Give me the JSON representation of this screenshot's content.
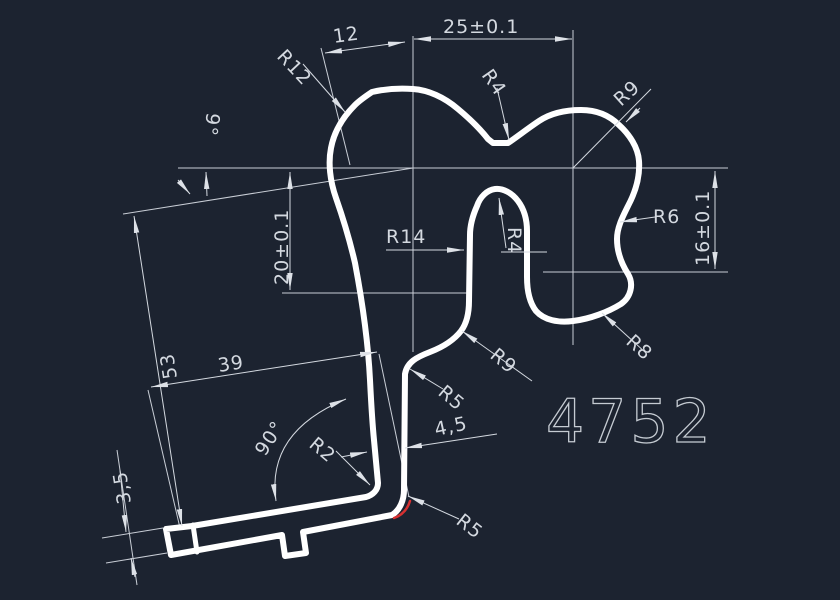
{
  "drawing": {
    "part_number": "4752",
    "colors": {
      "background": "#1c2330",
      "geometry": "#ffffff",
      "dimension_lines": "#d4d9e0",
      "highlight_red": "#d63031"
    },
    "labels": {
      "dim_12": "12",
      "dim_25": "25±0.1",
      "radius_r12": "R12",
      "radius_r4_top": "R4",
      "radius_r9_top_right": "R9",
      "angle_9deg": "9°",
      "dim_20": "20±0.1",
      "radius_r14": "R14",
      "radius_r4_slot": "R4",
      "radius_r6": "R6",
      "dim_16": "16±0.1",
      "radius_r9_mid": "R9",
      "radius_r8": "R8",
      "dim_53": "53",
      "dim_39": "39",
      "angle_90deg": "90°",
      "radius_r2": "R2",
      "radius_r5_mid": "R5",
      "dim_4_5": "4,5",
      "dim_3_5": "3,5",
      "radius_r5_bottom": "R5"
    }
  }
}
